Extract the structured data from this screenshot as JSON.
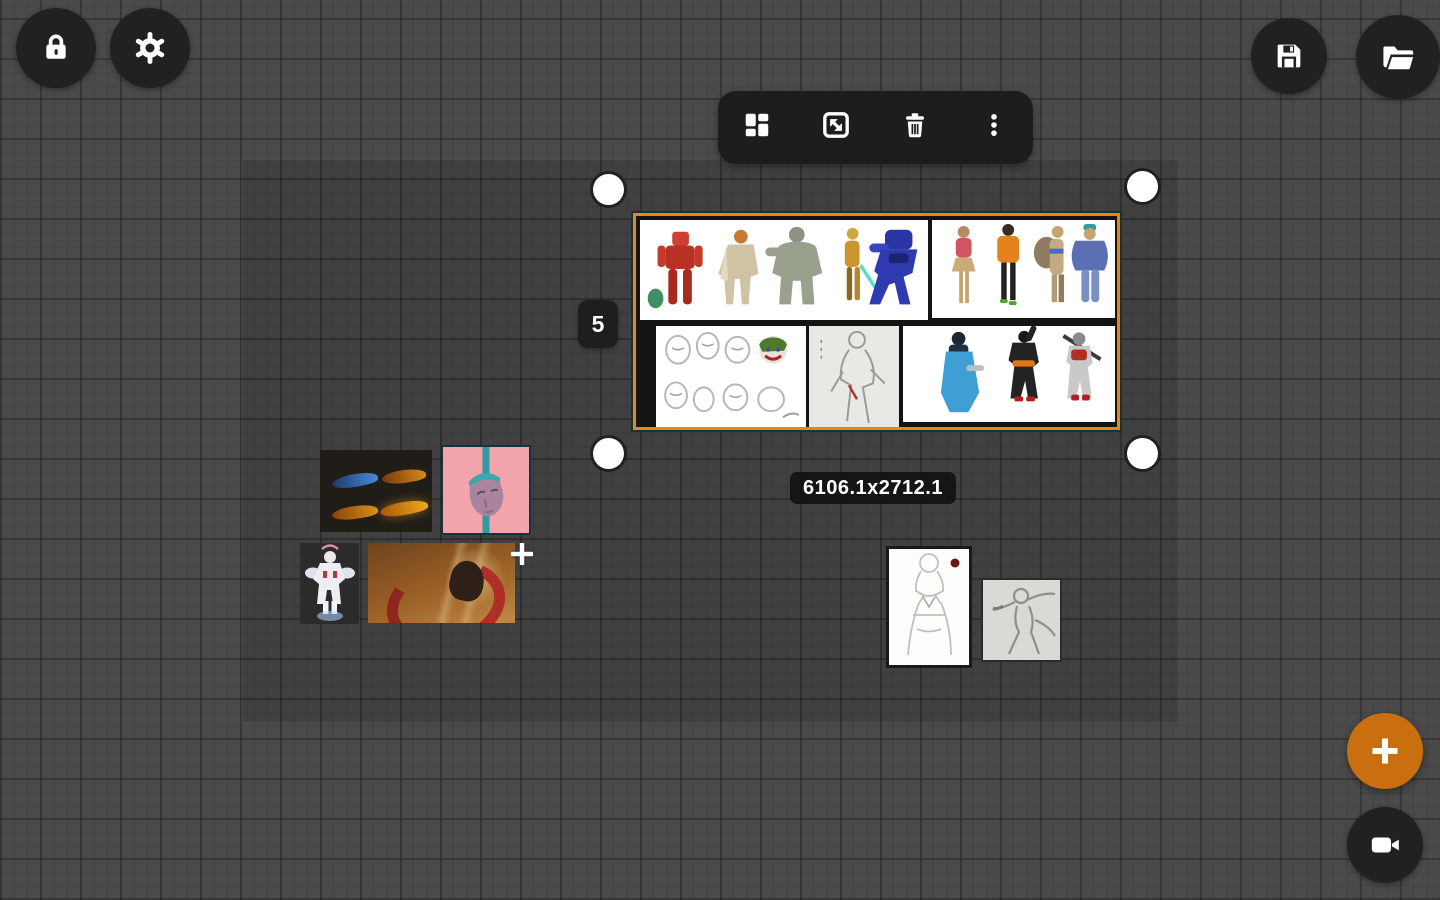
{
  "app": {
    "type": "reference-board-canvas"
  },
  "top_left_buttons": [
    {
      "name": "lock",
      "icon": "lock-icon"
    },
    {
      "name": "settings",
      "icon": "gear-icon"
    }
  ],
  "top_right_buttons": [
    {
      "name": "save",
      "icon": "floppy-disk-icon"
    },
    {
      "name": "open",
      "icon": "open-folder-icon"
    }
  ],
  "context_toolbar": {
    "buttons": [
      {
        "name": "arrange-layout",
        "icon": "dashboard-grid-icon"
      },
      {
        "name": "resize",
        "icon": "diagonal-resize-icon"
      },
      {
        "name": "delete",
        "icon": "trash-icon"
      },
      {
        "name": "more-options",
        "icon": "vertical-dots-icon"
      }
    ]
  },
  "selection": {
    "count": "5",
    "dimensions": "6106.1x2712.1",
    "border_color": "#E8860D",
    "images": [
      {
        "name": "character-lineup-five-colored"
      },
      {
        "name": "character-lineup-four-colored"
      },
      {
        "name": "face-study-sketch-sheet"
      },
      {
        "name": "pencil-figure-sketch"
      },
      {
        "name": "warrior-trio-concepts"
      }
    ]
  },
  "canvas_images": [
    {
      "name": "flame-sprite-sheet"
    },
    {
      "name": "pink-pixel-head"
    },
    {
      "name": "white-mech-character"
    },
    {
      "name": "orange-dragon-scene"
    },
    {
      "name": "dress-figure-sketch"
    },
    {
      "name": "action-pose-sketch"
    }
  ],
  "fab": {
    "name": "add",
    "icon": "plus-icon",
    "color": "#C96F10"
  },
  "record_button": {
    "name": "record",
    "icon": "video-camera-icon"
  },
  "colors": {
    "canvas_bg": "#4a4a4a",
    "board_region_overlay": "rgba(0,0,0,0.135)",
    "button_dark": "#212121",
    "selection_orange": "#E8860D",
    "fab_orange": "#C96F10"
  }
}
